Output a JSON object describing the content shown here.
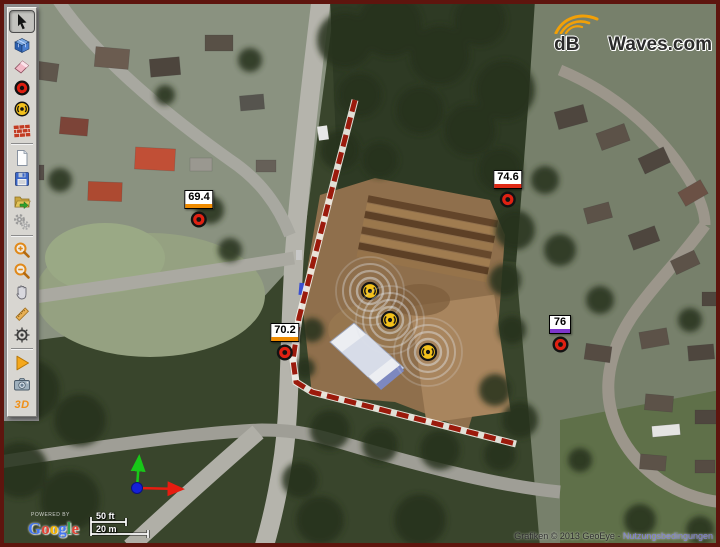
{
  "brand": {
    "prefix": "dB",
    "suffix": "Waves.com"
  },
  "toolbar": {
    "three_d_label": "3D",
    "items": [
      {
        "id": "select",
        "icon": "cursor-arrow-icon",
        "selected": true
      },
      {
        "id": "model-3d",
        "icon": "cube-3d-icon"
      },
      {
        "id": "eraser",
        "icon": "eraser-icon"
      },
      {
        "id": "add-receiver",
        "icon": "receiver-circle-icon"
      },
      {
        "id": "add-source",
        "icon": "source-circle-icon"
      },
      {
        "id": "add-barrier",
        "icon": "brick-wall-icon"
      },
      {
        "id": "new-project",
        "icon": "blank-page-icon"
      },
      {
        "id": "save",
        "icon": "floppy-disk-icon"
      },
      {
        "id": "open",
        "icon": "folder-arrow-icon"
      },
      {
        "id": "settings",
        "icon": "gears-icon"
      },
      {
        "id": "zoom-in",
        "icon": "magnifier-plus-icon"
      },
      {
        "id": "zoom-out",
        "icon": "magnifier-minus-icon"
      },
      {
        "id": "pan",
        "icon": "hand-icon"
      },
      {
        "id": "measure",
        "icon": "ruler-icon"
      },
      {
        "id": "compass",
        "icon": "helm-wheel-icon"
      },
      {
        "id": "run",
        "icon": "play-triangle-icon"
      },
      {
        "id": "snapshot",
        "icon": "camera-icon"
      },
      {
        "id": "view-3d",
        "icon": "3d-text-label"
      }
    ]
  },
  "map": {
    "receivers": [
      {
        "value": "69.4",
        "band_color": "#ef8b00",
        "x": 199,
        "y": 217
      },
      {
        "value": "74.6",
        "band_color": "#e02a16",
        "x": 508,
        "y": 197
      },
      {
        "value": "70.2",
        "band_color": "#ef8b00",
        "x": 285,
        "y": 350
      },
      {
        "value": "76",
        "band_color": "#7d35cc",
        "x": 560,
        "y": 342
      }
    ],
    "sources": [
      {
        "x": 370,
        "y": 291
      },
      {
        "x": 390,
        "y": 320
      },
      {
        "x": 428,
        "y": 352
      }
    ],
    "scalebar": {
      "imperial": "50 ft",
      "metric": "20 m"
    },
    "google": {
      "powered_by": "POWERED BY",
      "wordmark": "Google",
      "colors": [
        "#4476f1",
        "#e34234",
        "#f4b400",
        "#4476f1",
        "#34a052",
        "#e34234"
      ]
    },
    "attribution": {
      "text": "Grafiken © 2013 GeoEye - ",
      "link_label": "Nutzungsbedingungen"
    }
  }
}
